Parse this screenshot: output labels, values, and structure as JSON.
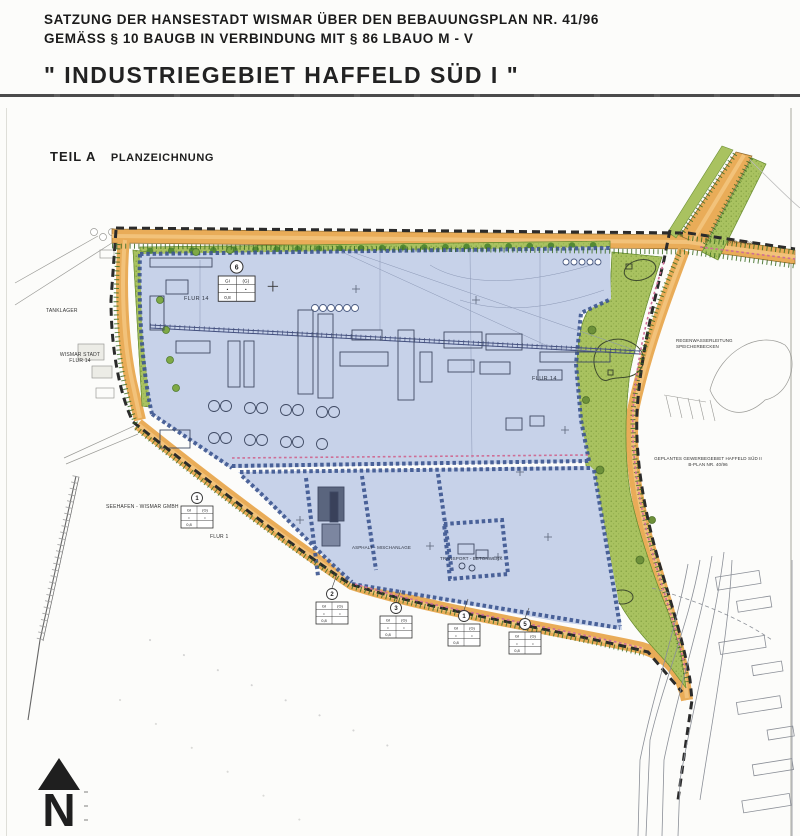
{
  "header": {
    "line1": "SATZUNG DER HANSESTADT WISMAR ÜBER DEN BEBAUUNGSPLAN NR. 41/96",
    "line2": "GEMÄSS § 10 BAUGB IN VERBINDUNG MIT § 86 LBAUO M - V",
    "main_title": "\" INDUSTRIEGEBIET HAFFELD SÜD I \""
  },
  "part": {
    "label_a": "TEIL A",
    "label_b": "PLANZEICHNUNG"
  },
  "map": {
    "labels": {
      "tanklager": "TANKLAGER",
      "wismar_stadt_1": "WISMAR STADT",
      "wismar_stadt_2": "FLUR 14",
      "flur14": "FLUR 14",
      "seehafen": "SEEHAFEN - WISMAR GMBH",
      "flur1": "FLUR 1",
      "asphalt": "ASPHALT - MISCHANLAGE",
      "transport": "TRANSPORT - BETONWERK",
      "regenwasser_1": "REGENWASSERLEITUNG",
      "regenwasser_2": "SPEICHERBECKEN",
      "geplant_1": "GEPLANTES GEWERBEGEBIET HAFFELD SÜD II",
      "geplant_2": "B-PLAN NR. 40/96",
      "strasse": "STR. 24-28",
      "north": "N"
    },
    "schablonen": {
      "cells": {
        "r1c1": "GI",
        "r1c2": "(G)",
        "r2c1": "•",
        "r2c2": "•",
        "r3c1": "0,8",
        "r3c2": "·"
      },
      "numbers": {
        "upper": "6",
        "west": "1",
        "s1": "2",
        "s2": "3",
        "s3": "1",
        "s4": "5"
      }
    },
    "colors": {
      "road": "#E9AC58",
      "road_stripe": "#F2C27A",
      "green": "#A9C260",
      "industrial_area": "#C7D2E9",
      "parcel_border": "#3C5590",
      "plan_boundary": "#2B2B2B",
      "pipe_pink": "#CE6E96",
      "linework": "#8B8F97"
    }
  }
}
